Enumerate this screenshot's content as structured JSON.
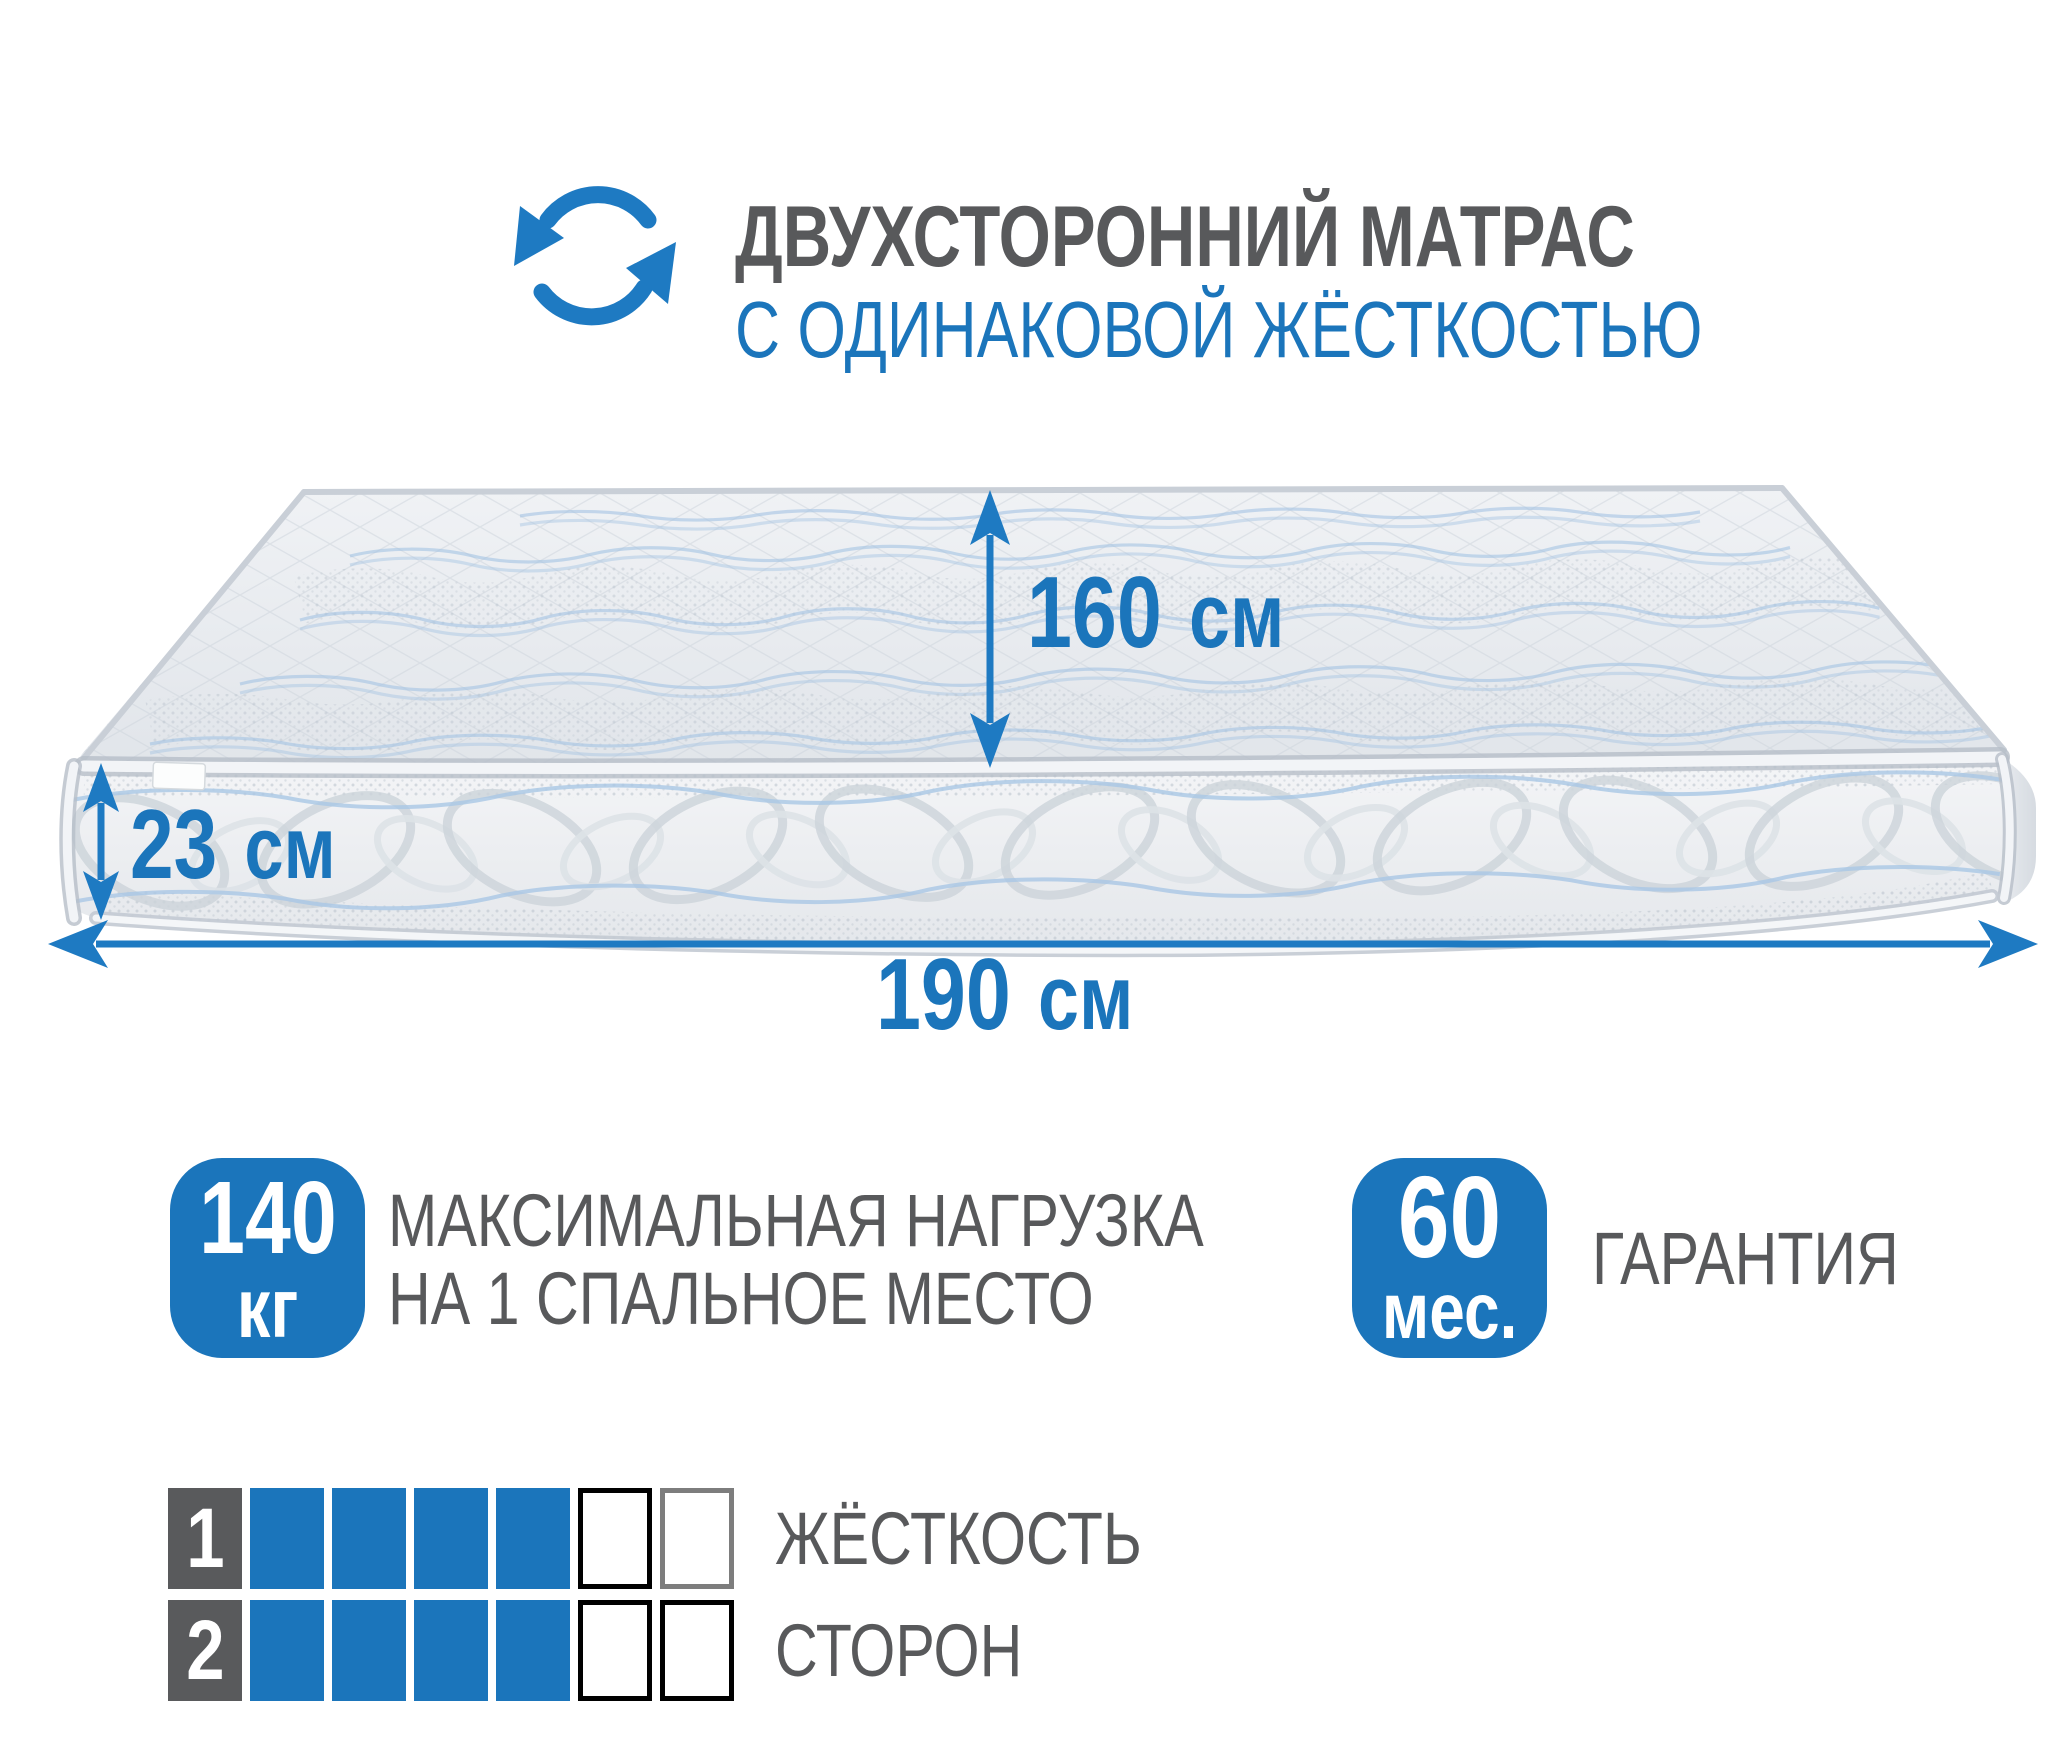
{
  "header": {
    "title_line1": "ДВУХСТОРОННИЙ МАТРАС",
    "title_line2": "С ОДИНАКОВОЙ ЖЁСТКОСТЬЮ"
  },
  "dimensions": {
    "width": {
      "value": "160",
      "unit": "см"
    },
    "height": {
      "value": "23",
      "unit": "см"
    },
    "length": {
      "value": "190",
      "unit": "см"
    }
  },
  "badges": {
    "max_load": {
      "value": "140",
      "unit": "кг",
      "desc_line1": "МАКСИМАЛЬНАЯ НАГРУЗКА",
      "desc_line2": "НА 1 СПАЛЬНОЕ МЕСТО"
    },
    "warranty": {
      "value": "60",
      "unit": "мес.",
      "label": "ГАРАНТИЯ"
    }
  },
  "firmness": {
    "label_line1": "ЖЁСТКОСТЬ",
    "label_line2": "СТОРОН",
    "scale_max": 6,
    "rows": [
      {
        "number": "1",
        "filled": 4,
        "empty": 2,
        "empty_border_colors": [
          "#000000",
          "#7d7d7d"
        ]
      },
      {
        "number": "2",
        "filled": 4,
        "empty": 2,
        "empty_border_colors": [
          "#000000",
          "#000000"
        ]
      }
    ]
  },
  "colors": {
    "accent_blue": "#1b75bb",
    "arrow_blue": "#1e7ac2",
    "text_gray": "#58595b",
    "number_square_gray": "#595a5c"
  }
}
